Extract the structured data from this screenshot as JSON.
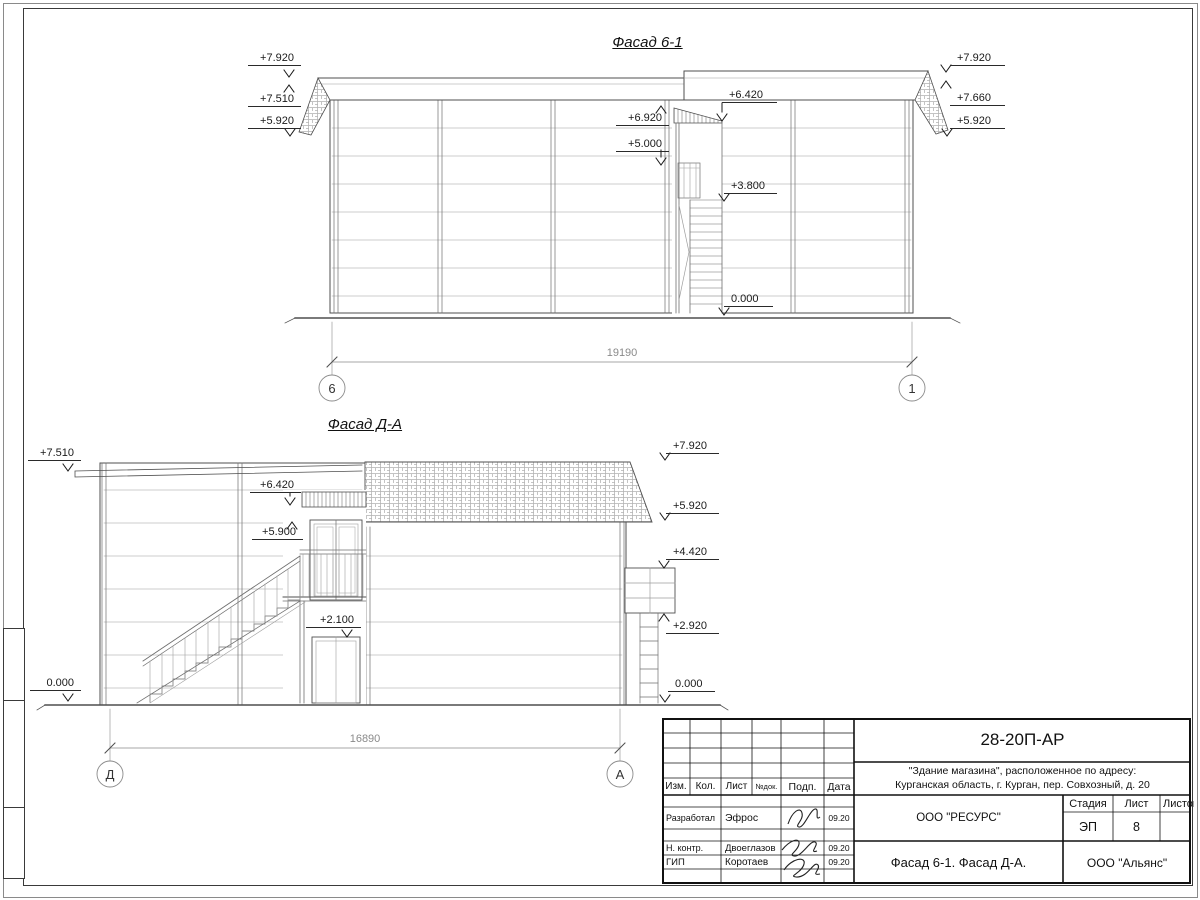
{
  "colors": {
    "line": "#4f4f4f",
    "panel_line": "#9e9e9e",
    "dim": "#8a8a8a",
    "text": "#1a1a1a"
  },
  "facade1": {
    "title": "Фасад 6-1",
    "dim": "19190",
    "axis_left": "6",
    "axis_right": "1",
    "marks_left": [
      "+7.920",
      "+7.510",
      "+5.920"
    ],
    "marks_right": [
      "+7.920",
      "+7.660",
      "+5.920"
    ],
    "marks_mid": [
      "+6.920",
      "+5.000",
      "+6.420",
      "+3.800",
      "0.000"
    ]
  },
  "facade2": {
    "title": "Фасад Д-А",
    "dim": "16890",
    "axis_left": "Д",
    "axis_right": "А",
    "marks_left": [
      "+7.510",
      "0.000"
    ],
    "marks_mid": [
      "+6.420",
      "+5.900",
      "+2.100"
    ],
    "marks_right": [
      "+7.920",
      "+5.920",
      "+4.420",
      "+2.920",
      "0.000"
    ]
  },
  "titleblock": {
    "doc_number": "28-20П-АР",
    "project_line1": "\"Здание магазина\", расположенное по адресу:",
    "project_line2": "Курганская область, г. Курган, пер. Совхозный, д. 20",
    "col_izm": "Изм.",
    "col_kol": "Кол.",
    "col_list": "Лист",
    "col_ndok": "№док.",
    "col_podp": "Подп.",
    "col_data": "Дата",
    "rows": [
      {
        "role": "Разработал",
        "name": "Эфрос",
        "date": "09.20"
      },
      {
        "role": "Н. контр.",
        "name": "Двоеглазов",
        "date": "09.20"
      },
      {
        "role": "ГИП",
        "name": "Коротаев",
        "date": "09.20"
      }
    ],
    "org1": "ООО \"РЕСУРС\"",
    "stage_label": "Стадия",
    "sheet_label": "Лист",
    "sheets_label": "Листов",
    "stage": "ЭП",
    "sheet_number": "8",
    "drawing_title": "Фасад 6-1. Фасад Д-А.",
    "org2": "ООО \"Альянс\""
  }
}
